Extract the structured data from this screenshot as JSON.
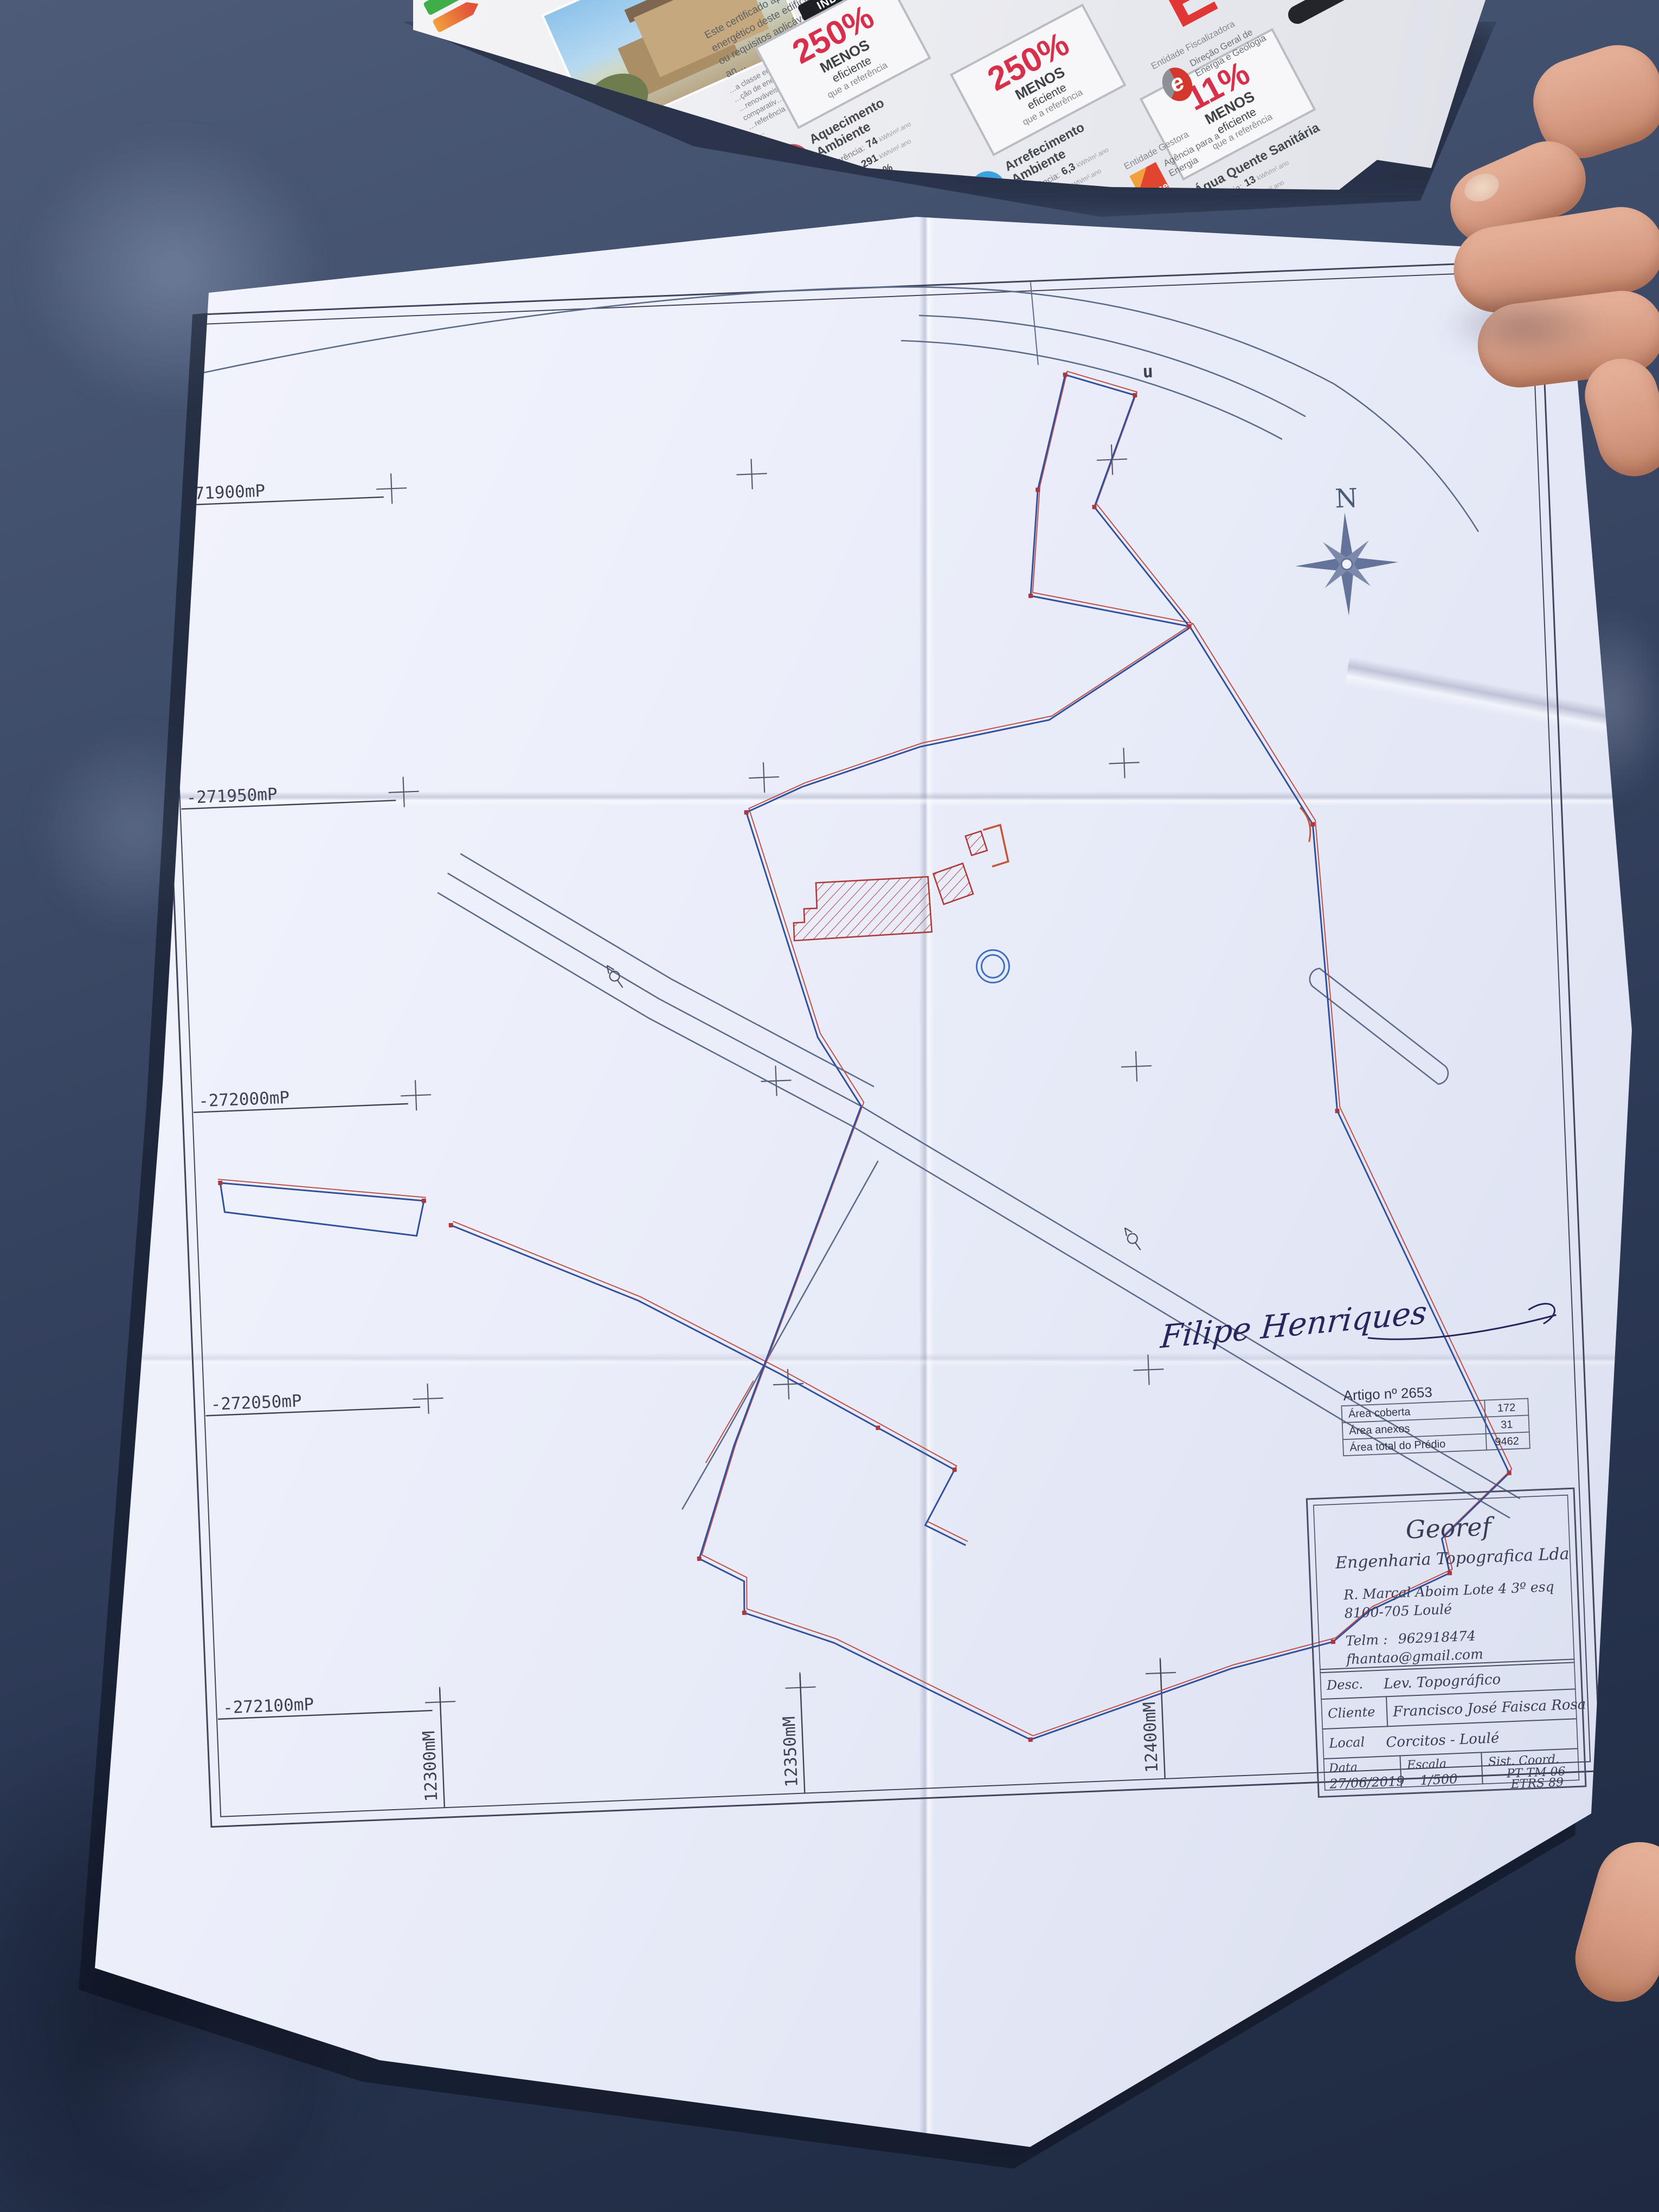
{
  "colors": {
    "table": "#35425f",
    "paper": "#eceffa",
    "boundary_blue": "#31519e",
    "boundary_red": "#c0504d",
    "road": "#5c6b8a",
    "hatch_red": "#b25050",
    "dgeg_red": "#d3372e",
    "adene_orange": "#e8702a",
    "icon_heat": "#d8485a",
    "icon_cool": "#38a3dc",
    "icon_water": "#e0763c"
  },
  "brochure": {
    "intro_lines": [
      "Este certificado apresenta a cla…",
      "energético deste edifício nas con…",
      "ou requisitos aplicáveis para o an…"
    ],
    "section_title": "INDICADORES DE DESEMPENHO",
    "note_lines": [
      "…a classe energética do edif…",
      "…ção de energia, incluindo o co…",
      "…renováveis. São apresentados comparativ…",
      "…referência e calculados em condições p…"
    ],
    "indicators": [
      {
        "name": "Aquecimento Ambiente",
        "icon_style": "background:#d8485a",
        "ref_label": "Referência:",
        "ref_value": "74",
        "ed_label": "Edifício:",
        "ed_value": "291",
        "ren_label": "Renovável",
        "ren_value": "- %",
        "unit": "kWh/m².ano",
        "pct": "250%",
        "pct_sub": "MENOS",
        "pct_line1": "eficiente",
        "pct_line2": "que a referência"
      },
      {
        "name": "Arrefecimento Ambiente",
        "icon_style": "background:#38a3dc",
        "ref_label": "Referência:",
        "ref_value": "6,3",
        "ed_label": "Edifício:",
        "ed_value": "27",
        "ren_label": "Renovável",
        "ren_value": "- %",
        "unit": "kWh/m².ano",
        "pct": "250%",
        "pct_sub": "MENOS",
        "pct_line1": "eficiente",
        "pct_line2": "que a referência"
      },
      {
        "name": "Água Quente Sanitária",
        "icon_style": "background:#e0763c",
        "ref_label": "Referência:",
        "ref_value": "13",
        "ed_label": "Edifício:",
        "ed_value": "21",
        "ren_label": "Renovável",
        "ren_value": "- %",
        "unit": "kWh/m².ano",
        "pct": "11%",
        "pct_sub": "MENOS",
        "pct_line1": "eficiente",
        "pct_line2": "que a referência"
      }
    ],
    "entities": {
      "fisc_label": "Entidade Fiscalizadora",
      "fisc_name": "Direção Geral de Energia e Geologia",
      "gest_label": "Entidade Gestora",
      "gest_logo": "adene",
      "gest_name": "Agência para a Energia",
      "class_letter": "E"
    }
  },
  "plan": {
    "north": "N",
    "boundary_mark": "u",
    "grid": {
      "left_labels": [
        "-271900mP",
        "-271950mP",
        "-272000mP",
        "-272050mP",
        "-272100mP"
      ],
      "bottom_labels": [
        "12300mM",
        "12350mM",
        "12400mM"
      ]
    },
    "signature": "Filipe Henriques",
    "artigo": {
      "title": "Artigo nº 2653",
      "rows": [
        {
          "label": "Área coberta",
          "value": "172"
        },
        {
          "label": "Área anexos",
          "value": "31"
        },
        {
          "label": "Área total do Prédio",
          "value": "9462"
        }
      ]
    },
    "title_block": {
      "company": "Georef",
      "subtitle": "Engenharia Topografica Lda",
      "address1": "R. Marçal Aboim Lote 4 3º esq",
      "address2": "8100-705 Loulé",
      "phone_label": "Telm :",
      "phone": "962918474",
      "email": "fhantao@gmail.com",
      "desc_label": "Desc.",
      "desc": "Lev. Topográfico",
      "client_label": "Cliente",
      "client": "Francisco José Faisca Rosa",
      "local_label": "Local",
      "local": "Corcitos - Loulé",
      "date_label": "Data",
      "date": "27/06/2019",
      "scale_label": "Escala",
      "scale": "1/500",
      "coord_label": "Sist. Coord.",
      "coord1": "PT TM 06",
      "coord2": "ETRS 89"
    }
  }
}
